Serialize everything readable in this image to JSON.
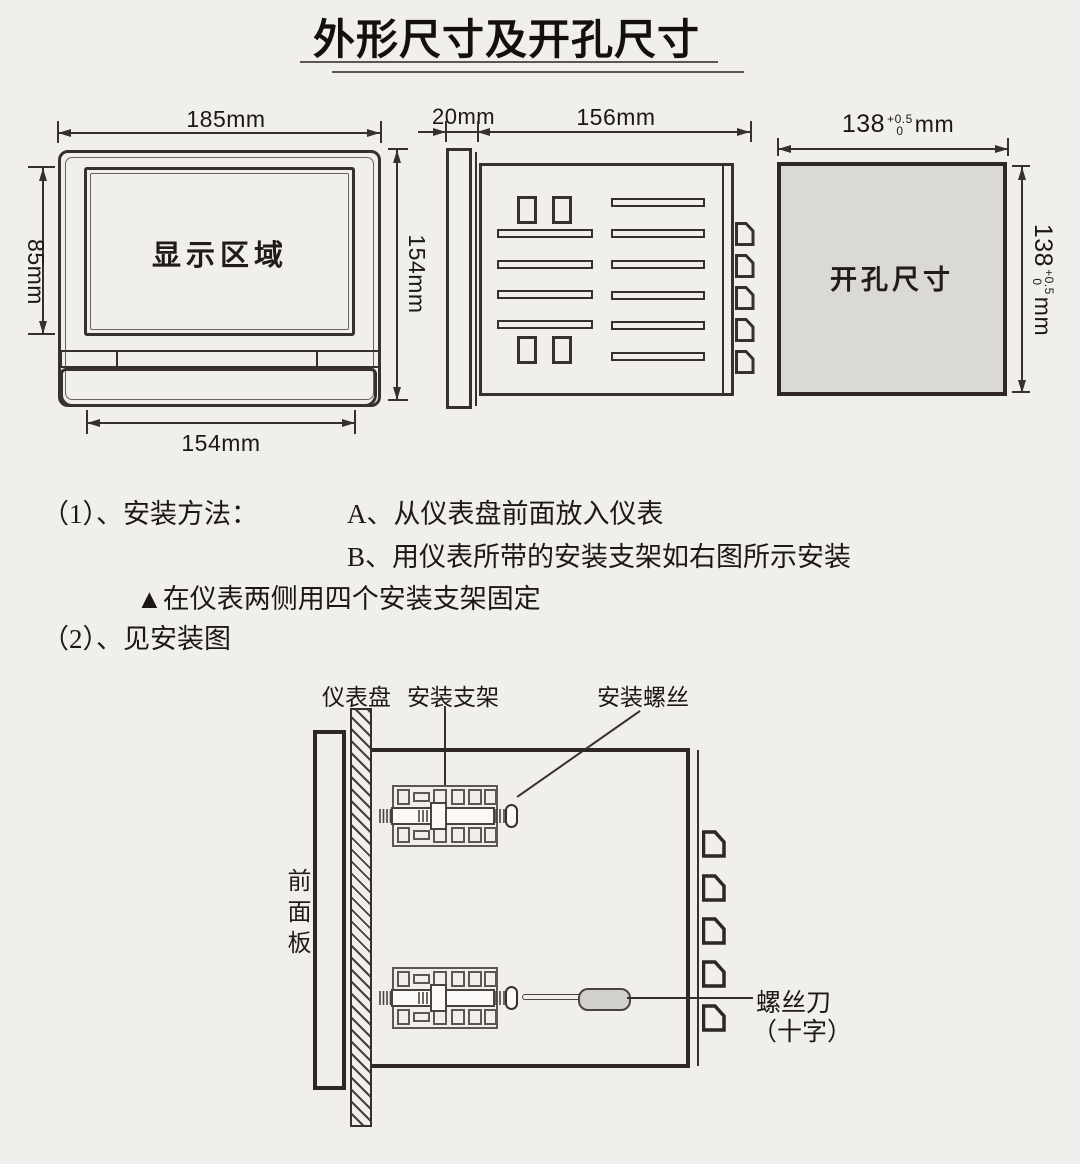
{
  "title": "外形尺寸及开孔尺寸",
  "front_view": {
    "width": "185mm",
    "display_area": "显示区域",
    "display_height": "85mm",
    "height": "154mm",
    "bottom_width": "154mm"
  },
  "side_view": {
    "bezel_depth": "20mm",
    "body_depth": "156mm"
  },
  "cutout": {
    "label": "开孔尺寸",
    "value": "138",
    "tol_upper": "+0.5",
    "tol_lower": "0",
    "unit": "mm"
  },
  "instructions": {
    "item1": "（1）、安装方法：",
    "step_a": "A、从仪表盘前面放入仪表",
    "step_b": "B、用仪表所带的安装支架如右图所示安装",
    "note": "▲在仪表两侧用四个安装支架固定",
    "item2": "（2）、见安装图"
  },
  "install": {
    "panel": "仪表盘",
    "bracket": "安装支架",
    "screw": "安装螺丝",
    "front_panel": "前面板",
    "screwdriver": "螺丝刀",
    "screwdriver_type": "（十字）"
  },
  "colors": {
    "line": "#38302a",
    "background": "#f0efec",
    "cutout_fill": "#dbd9d6",
    "handle_fill": "#d2d0cc"
  }
}
